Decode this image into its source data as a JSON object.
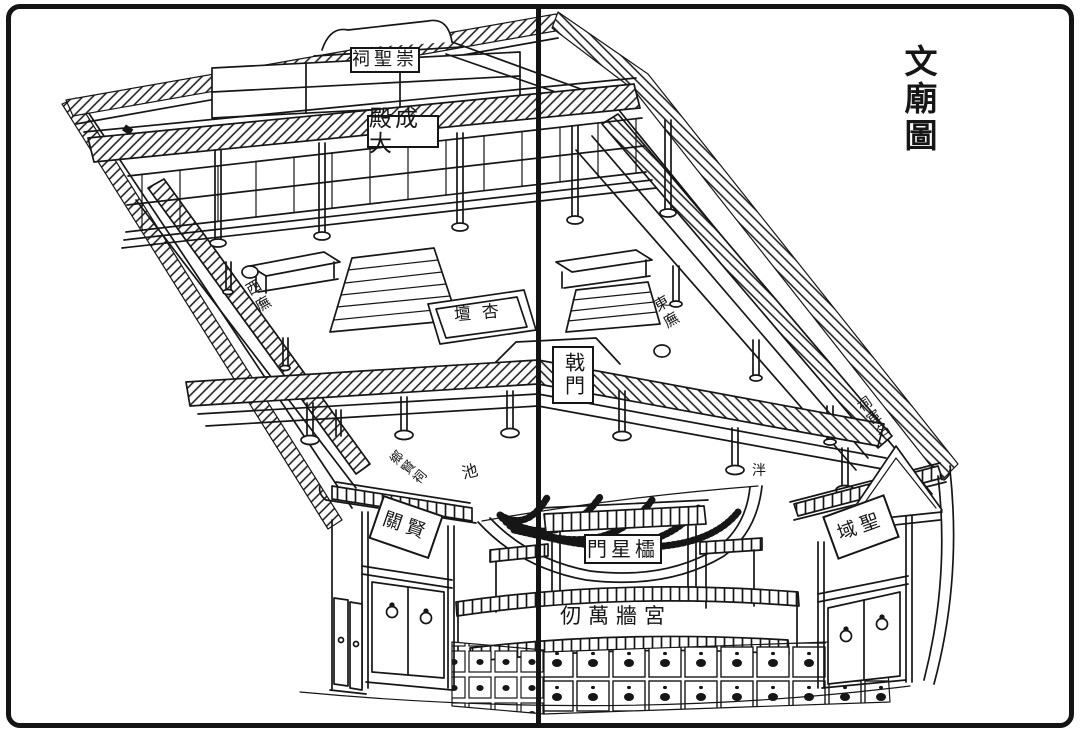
{
  "page": {
    "title": "文廟圖"
  },
  "plaques": {
    "chongsheng_shrine": {
      "text": "祠聖崇"
    },
    "dacheng_hall": {
      "text": "殿成大"
    },
    "ji_gate": {
      "text": "戟門"
    },
    "lingxing_gate": {
      "text": "門星櫺"
    },
    "xianguan_gate": {
      "text": "關賢"
    },
    "shengyu_gate": {
      "text": "域聖"
    },
    "palace_wall_motto": {
      "text": "仞萬牆宮"
    }
  },
  "field_labels": {
    "west_wing": {
      "text": "西廡"
    },
    "east_wing": {
      "text": "東廡"
    },
    "apricot_altar": {
      "text": "壇杏"
    },
    "pond_char_left": {
      "text": "池"
    },
    "pond_char_right": {
      "text": "泮"
    },
    "local_worthies_shrine": {
      "text": "鄉賢祠"
    },
    "famous_officials_shrine": {
      "text": "祠宦名"
    }
  },
  "colors": {
    "ink": "#161616",
    "paper": "#ffffff"
  }
}
